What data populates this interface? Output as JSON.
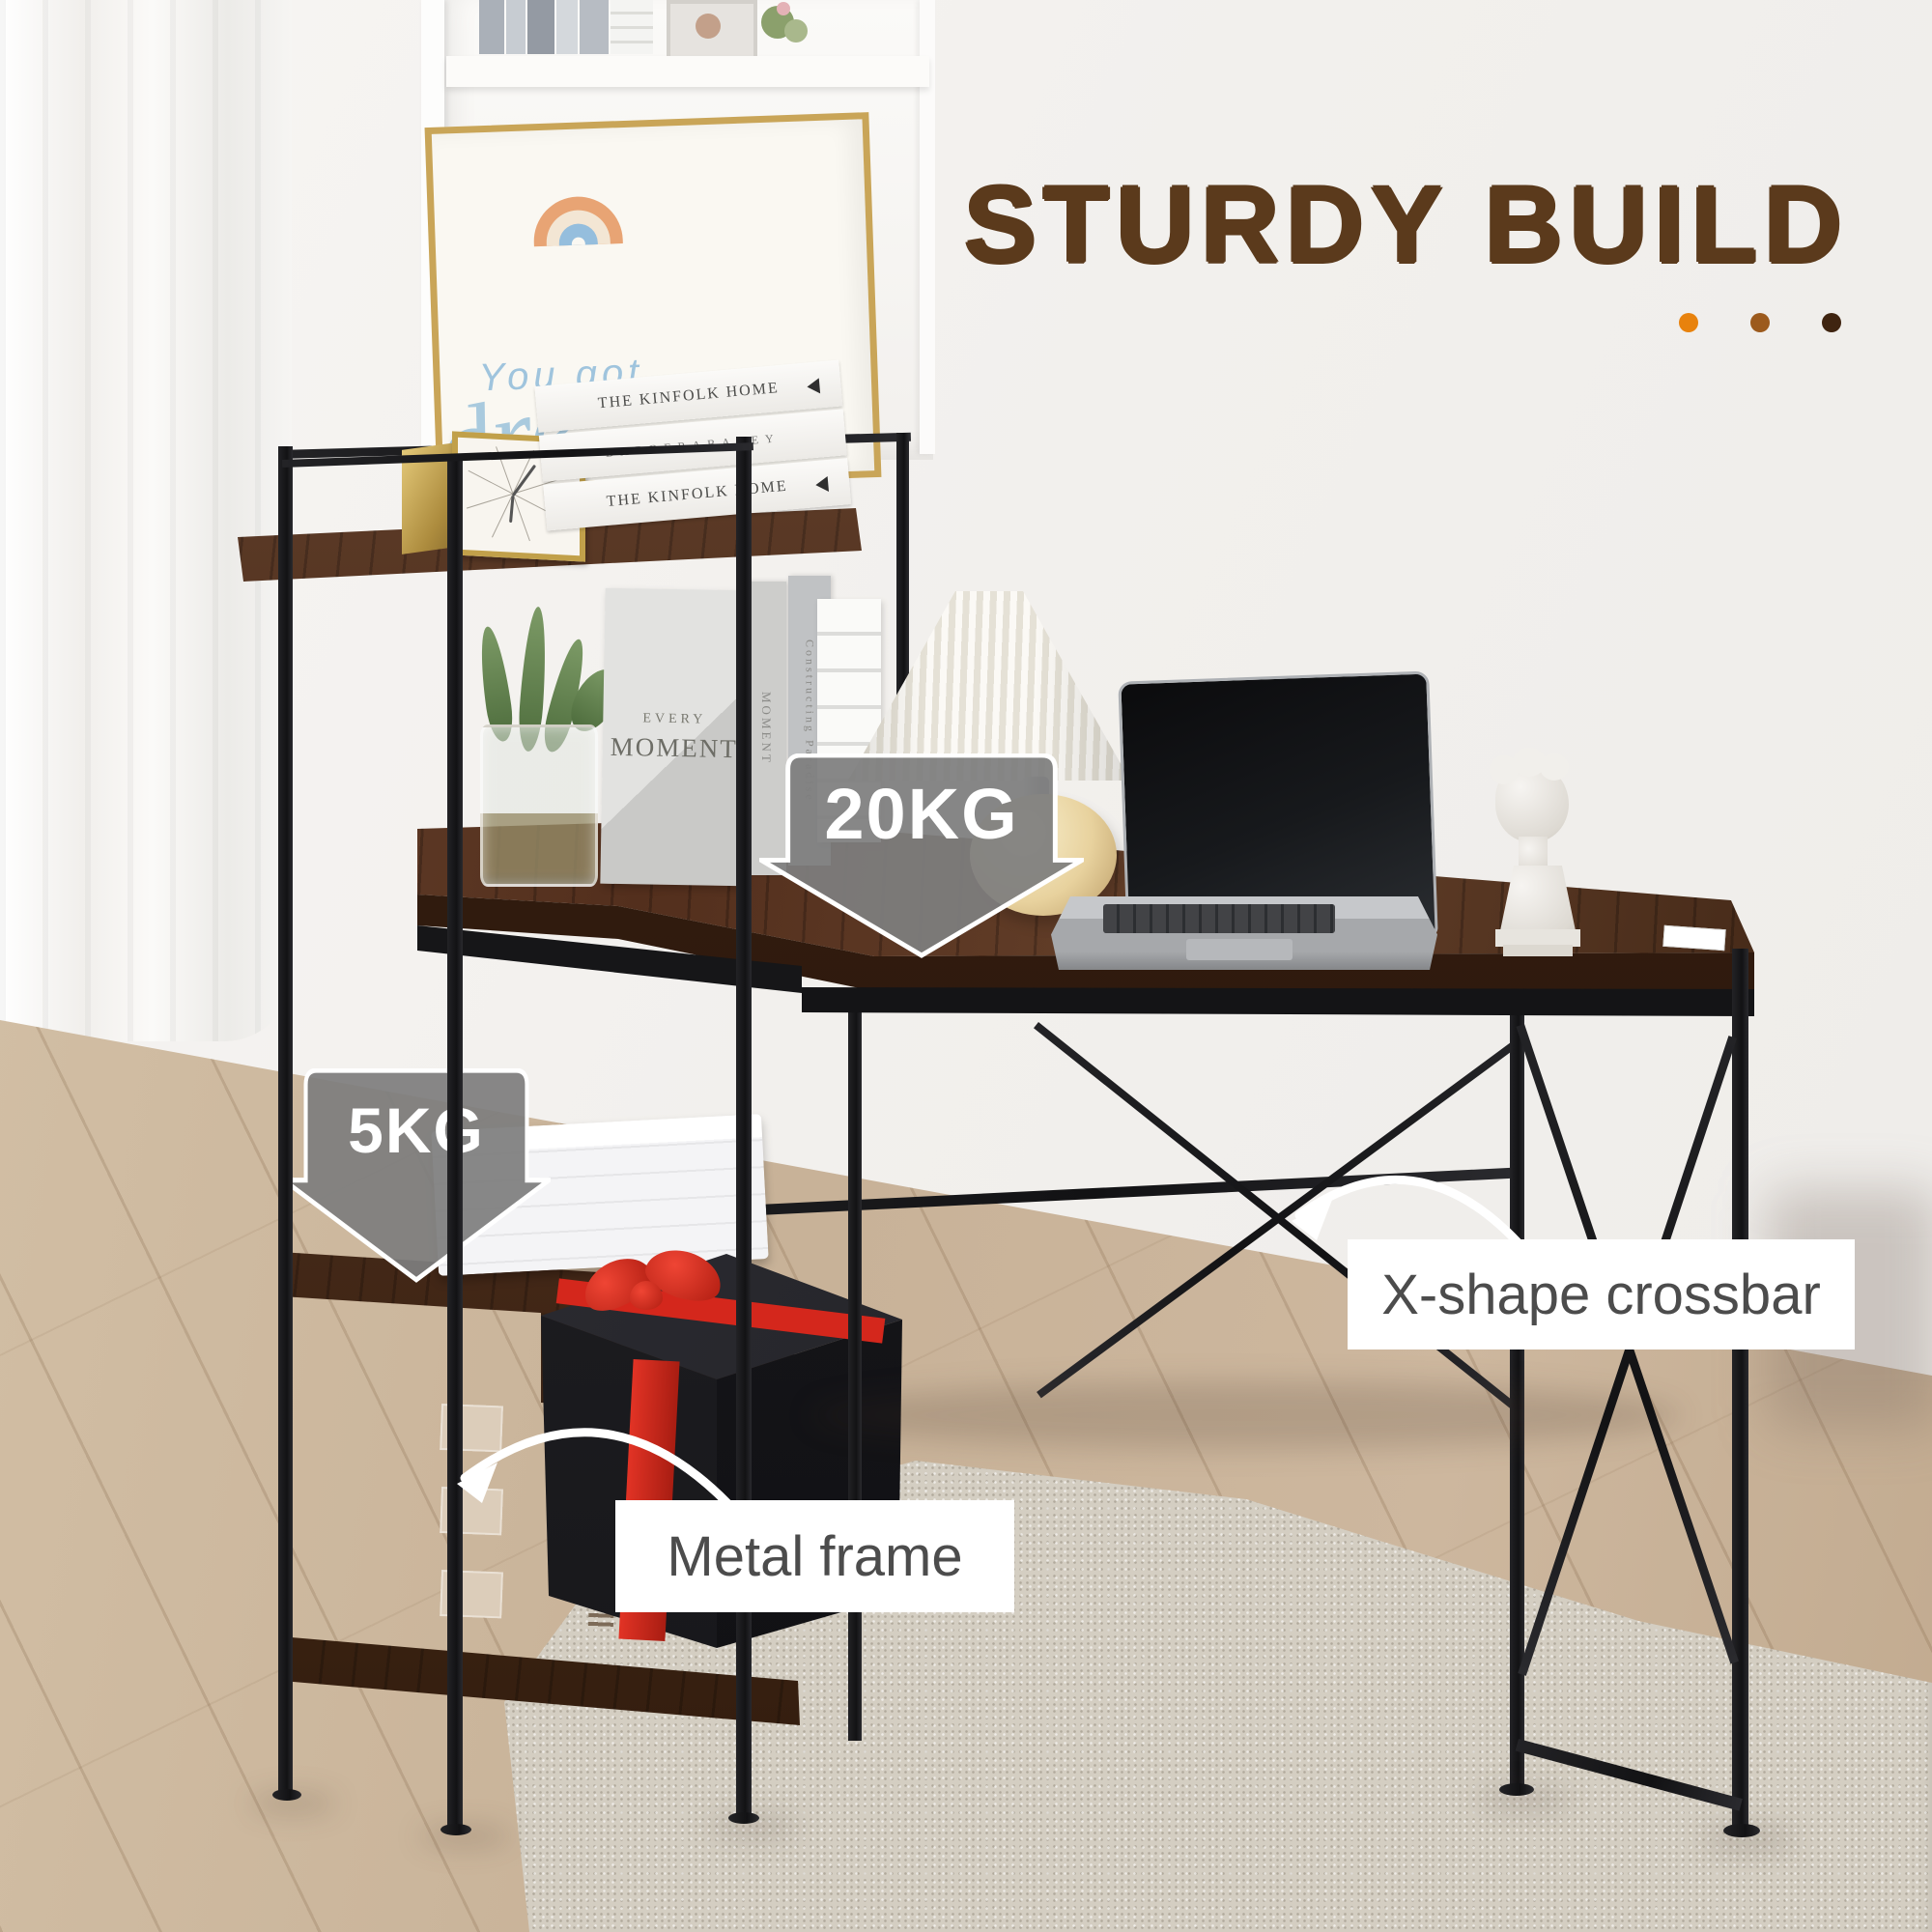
{
  "header": {
    "title": "STURDY BUILD",
    "dot_colors": [
      "#e8820d",
      "#9c5a1d",
      "#3f2410"
    ]
  },
  "callouts": {
    "desk_capacity": "20KG",
    "shelf_capacity": "5KG",
    "crossbar_label": "X-shape crossbar",
    "frame_label": "Metal frame"
  },
  "scene": {
    "books_top": [
      "THE KINFOLK HOME",
      "BARBERABAREY",
      "THE KINFOLK HOME"
    ],
    "poster_line1": "You got",
    "poster_line2": "dre",
    "cover_book_word1": "EVERY",
    "cover_book_word2": "MOMENT",
    "spine_book_1": "MOMENT",
    "spine_book_2": "Constructing Paradise",
    "laptop_brand": "MacBook Pro"
  },
  "colors": {
    "title_brown": "#5b3a1c",
    "arrow_gray": "#808080",
    "wood_brown": "#53301d",
    "metal_black": "#1a1a1c",
    "ribbon_red": "#d4271c",
    "label_text": "#4c4c4c"
  }
}
